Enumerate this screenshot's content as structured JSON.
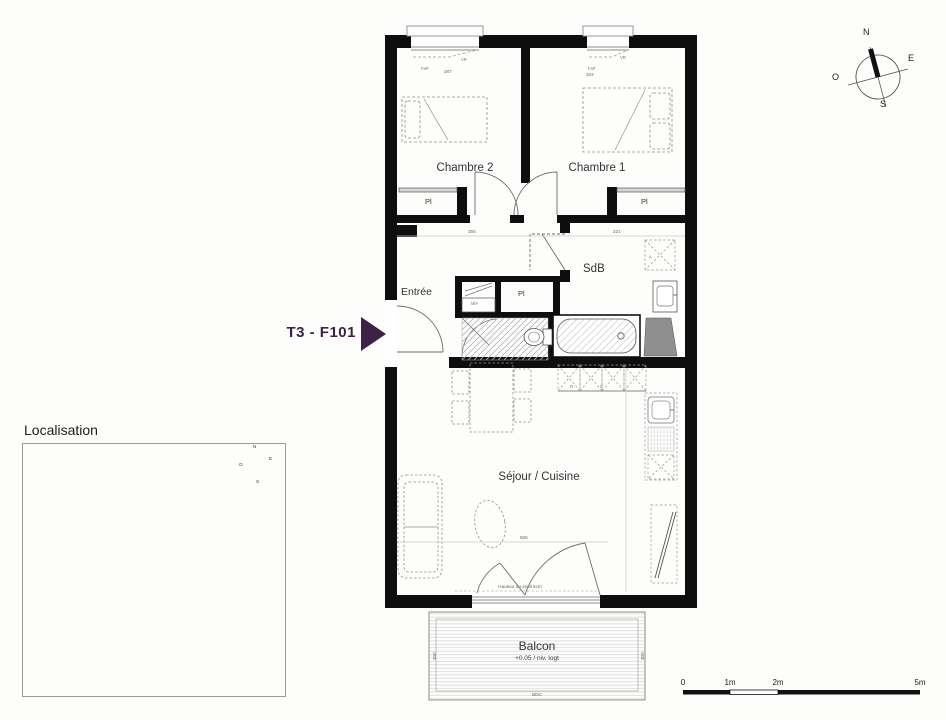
{
  "unit": {
    "label": "T3 - F101"
  },
  "rooms": {
    "chambre2": "Chambre 2",
    "chambre1": "Chambre 1",
    "sdb": "SdB",
    "entree": "Entrée",
    "sejour": "Séjour / Cuisine",
    "balcon": "Balcon",
    "balcon_level": "+0.05 / niv. logt"
  },
  "closets": {
    "pl_left": "Pl",
    "pl_right": "Pl",
    "pl_hall": "Pl",
    "mla": "MlA"
  },
  "kitchen": {
    "fridge": "R",
    "cooktop": "C"
  },
  "labels": {
    "fap": "FaP",
    "vr": "VR",
    "f": "F",
    "threshold": "Hauteur du seuil 5cm"
  },
  "dims": {
    "hall_left": "356",
    "hall_right": "221",
    "window_c2": "287",
    "window_c1": "322",
    "sejour_width": "555",
    "balcon_side_left": "300",
    "balcon_side_right": "300",
    "balcon_bottom": "BDC"
  },
  "compass": {
    "n": "N",
    "e": "E",
    "s": "S",
    "o": "O"
  },
  "localisation": {
    "title": "Localisation",
    "unit_label": "F101"
  },
  "scalebar": {
    "t0": "0",
    "t1": "1m",
    "t2": "2m",
    "t5": "5m"
  },
  "colors": {
    "accent_purple": "#3E2147",
    "wall": "#0e0e0e"
  }
}
